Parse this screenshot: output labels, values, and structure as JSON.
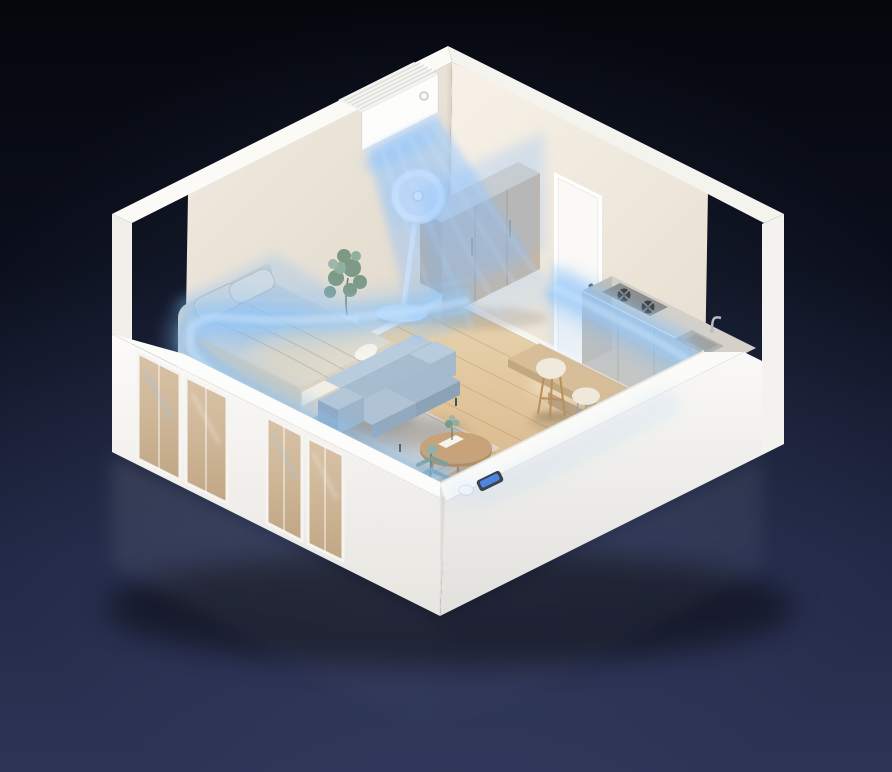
{
  "scene": {
    "title": "Isometric cutaway room showing air conditioner airflow circulating around the whole apartment",
    "objects": [
      {
        "id": "air-conditioner",
        "label": "Wall-mounted air conditioner blowing cool air"
      },
      {
        "id": "airflow",
        "label": "Blue airflow stream circulating around the room perimeter"
      },
      {
        "id": "pedestal-fan",
        "label": "White pedestal fan"
      },
      {
        "id": "wardrobe",
        "label": "Wooden wardrobe cabinet"
      },
      {
        "id": "door",
        "label": "White interior door"
      },
      {
        "id": "bed",
        "label": "Double bed with two pillows and duvet"
      },
      {
        "id": "rug",
        "label": "Gray area rug"
      },
      {
        "id": "nightstand-left",
        "label": "Small bedside cabinet with device"
      },
      {
        "id": "nightstand-right",
        "label": "Wooden nightstand"
      },
      {
        "id": "plant-tall",
        "label": "Tall potted plant on stand"
      },
      {
        "id": "plant-front",
        "label": "Feathery potted plant near front wall"
      },
      {
        "id": "sofa",
        "label": "Blue-gray two-seat sofa"
      },
      {
        "id": "coffee-table",
        "label": "Round wooden coffee table with plant and book"
      },
      {
        "id": "dining-table",
        "label": "Wooden dining bar table"
      },
      {
        "id": "bar-stools",
        "label": "Two cream bar stools"
      },
      {
        "id": "kitchen-counter",
        "label": "Kitchen counter with gas hob and sink"
      },
      {
        "id": "smart-controller",
        "label": "Small smart controller with blue screen on ledge"
      },
      {
        "id": "windows",
        "label": "Sliding windows in the low front walls"
      }
    ]
  },
  "palette": {
    "bg_top": "#05070D",
    "bg_bottom": "#2E3456",
    "airflow": "#7FBCF5",
    "airflow_bright": "#C9E4FF",
    "wall_left": "#E9E2D6",
    "wall_right": "#F2ECE1",
    "wall_white": "#FAF9F6",
    "floor_light": "#E7D2AC",
    "floor_dark": "#D3AC7E",
    "wood": "#CBB69D",
    "wood_dark": "#C8A279",
    "sofa": "#A7BCCF",
    "rug": "#D2CFC9",
    "counter": "#D5D1C9",
    "duvet": "#DAD4C6",
    "foliage": "#7C9A86",
    "device_screen": "#4A7FE0"
  }
}
